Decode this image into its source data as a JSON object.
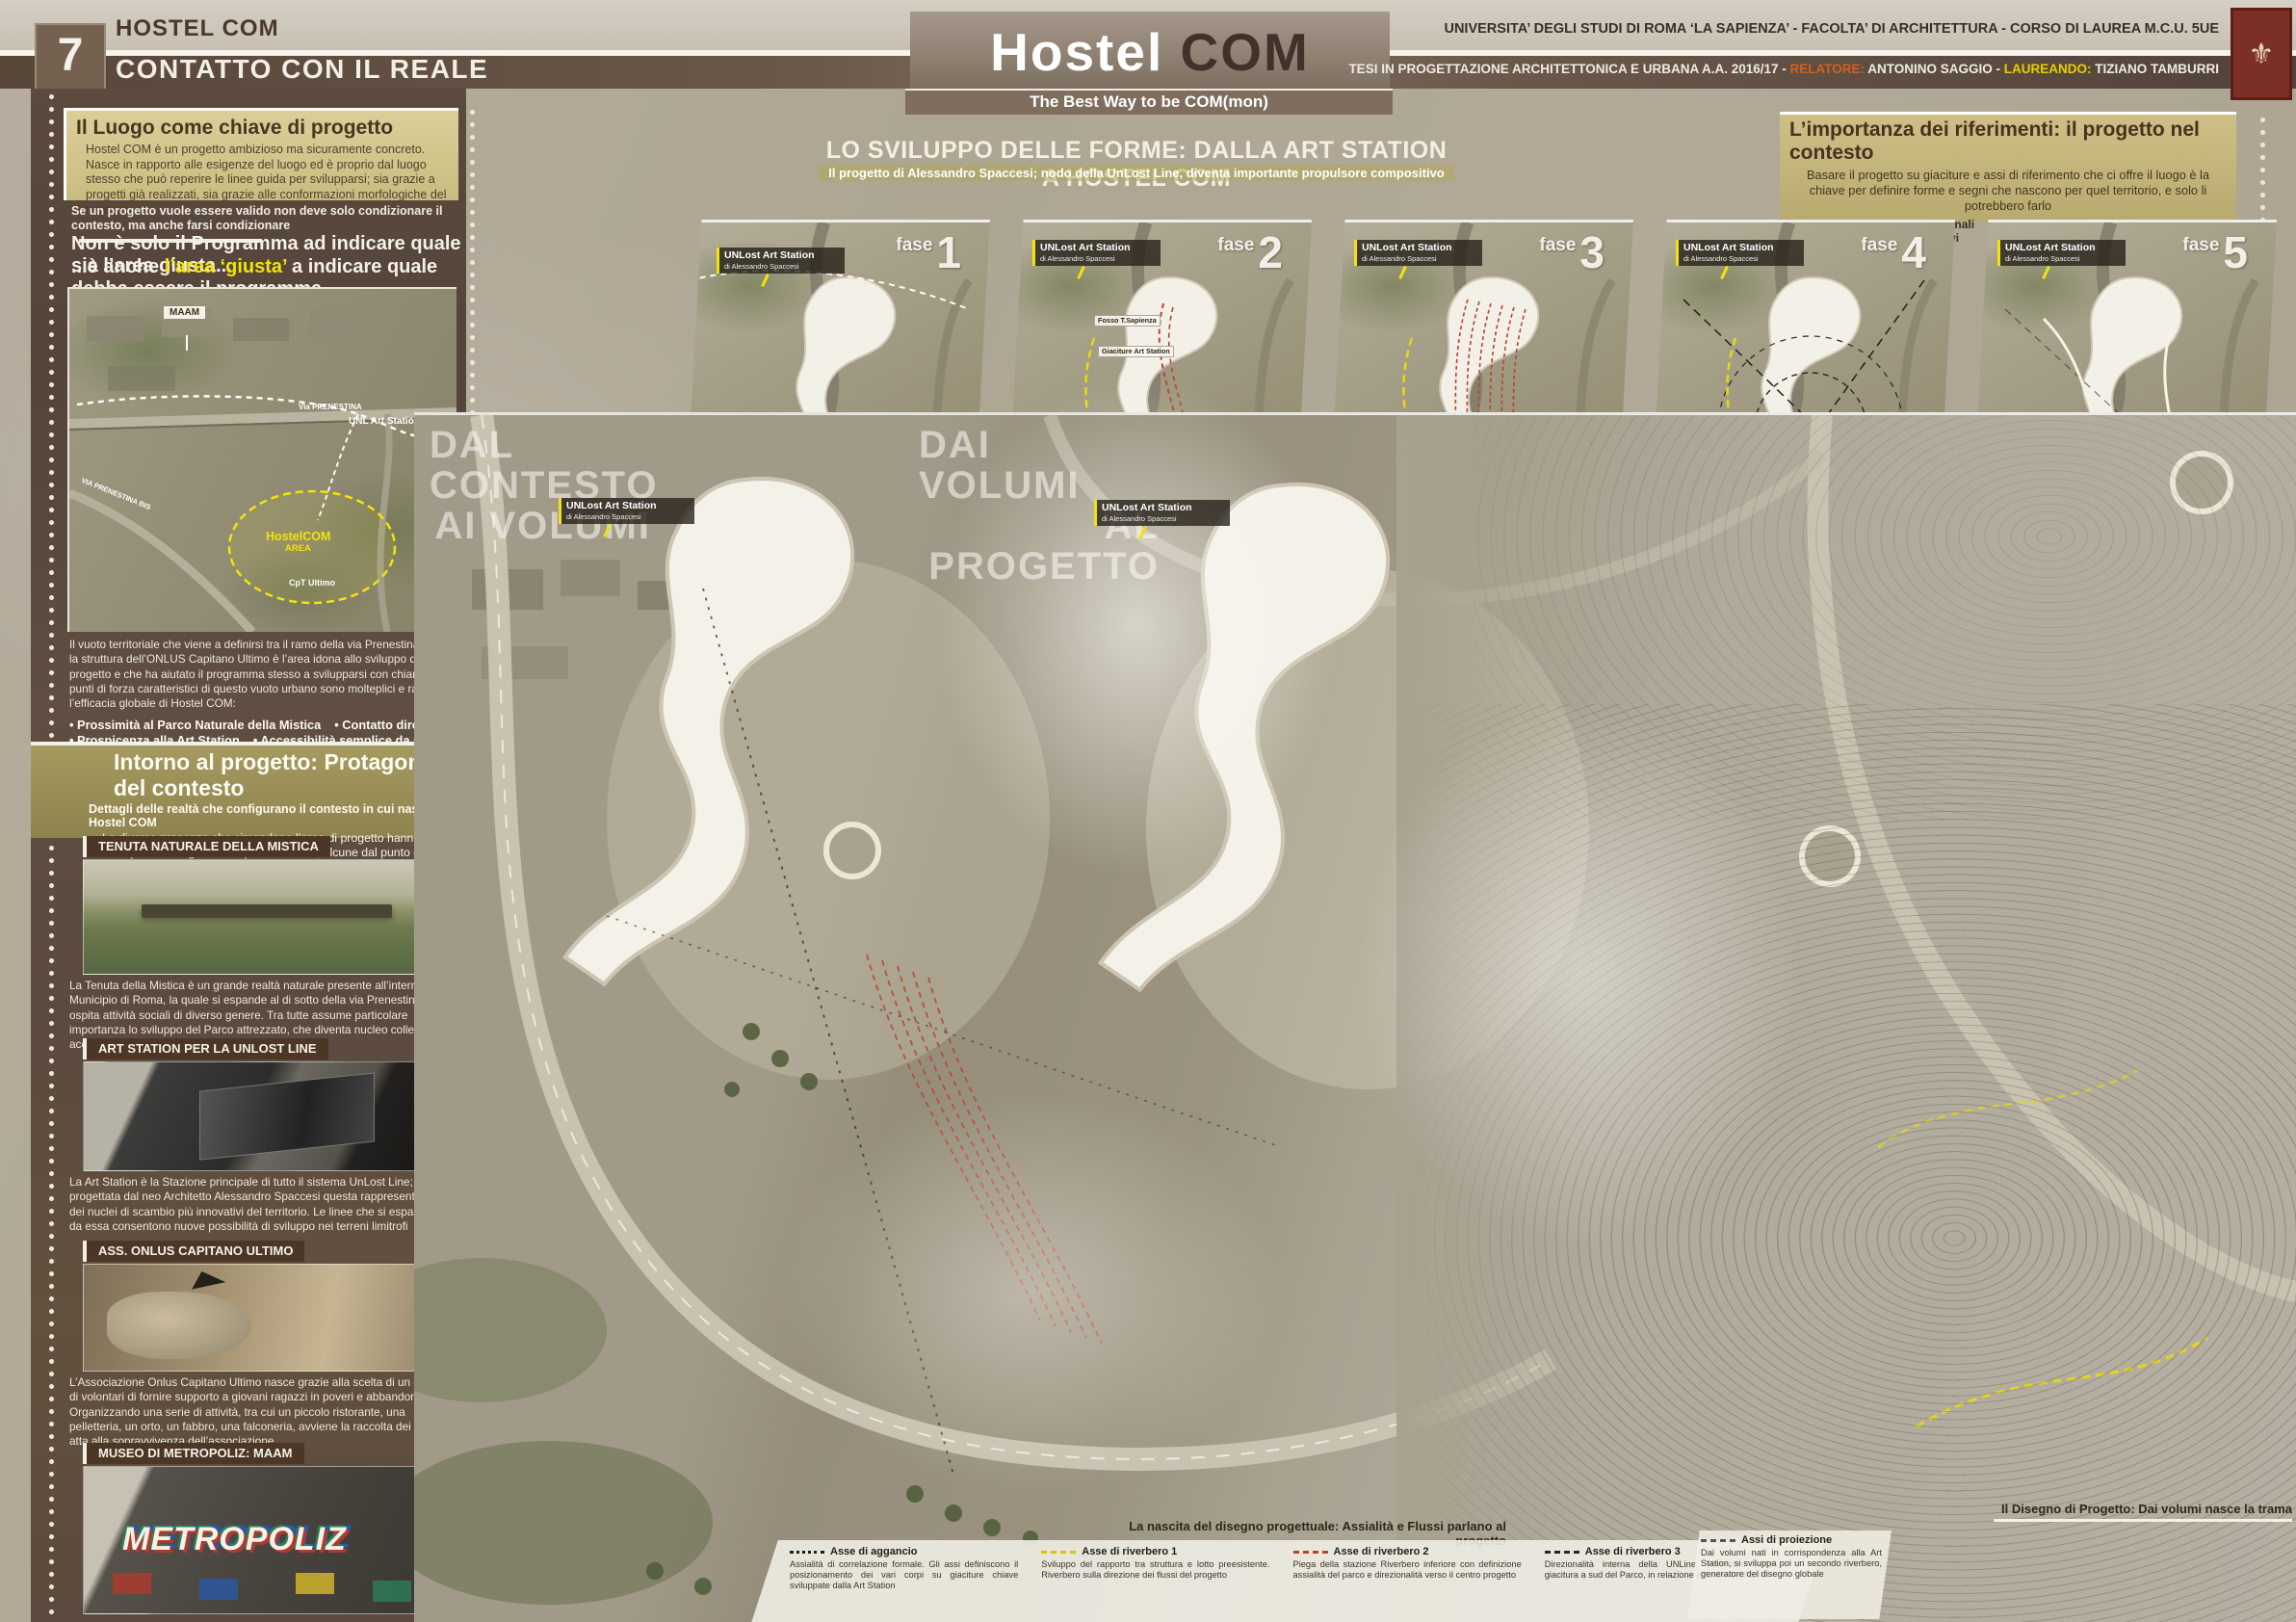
{
  "colors": {
    "accent_yellow": "#f2e30c",
    "axis_red": "#b8432f",
    "relatore_orange": "#d2601e",
    "laureando_yellow": "#e6d000",
    "panel_brown": "#5b4a3d",
    "olive": "#a59a5f"
  },
  "header": {
    "page_number": "7",
    "project": "HOSTEL COM",
    "chapter": "CONTATTO CON IL REALE",
    "title_white": "Hostel",
    "title_brown": "COM",
    "subtitle": "The Best Way to be COM(mon)",
    "university_line": "UNIVERSITA’ DEGLI STUDI DI ROMA ‘LA SAPIENZA’ - FACOLTA’ DI ARCHITETTURA - CORSO DI LAUREA M.C.U. 5UE",
    "thesis_prefix": "TESI IN PROGETTAZIONE ARCHITETTONICA E URBANA A.A. 2016/17 - ",
    "relatore_label": "RELATORE:",
    "relatore_name": " ANTONINO SAGGIO - ",
    "laureando_label": "LAUREANDO:",
    "laureando_name": " TIZIANO TAMBURRI",
    "logo_glyph": "⚜"
  },
  "left": {
    "intro": {
      "heading": "Il Luogo come chiave di progetto",
      "body": "Hostel COM è un progetto ambizioso ma sicuramente concreto. Nasce in rapporto alle esigenze del luogo ed è proprio dal luogo stesso che può reperire le linee guida per svilupparsi; sia grazie a progetti già realizzati, sia grazie alle conformazioni morfologiche del territorio"
    },
    "statement": {
      "small": "Se un progetto vuole essere valido non deve solo condizionare il contesto, ma anche farsi condizionare",
      "line1": "Non è solo il Programma ad indicare quale sia l’area giusta...",
      "line2_pre": "...è anche ",
      "line2_hl": "l’area ‘giusta’",
      "line2_post": " a indicare quale debba essere il programma"
    },
    "map_labels": {
      "maam": "MAAM",
      "via_prenestina": "Via PRENESTINA",
      "via_prenestina_bis": "VIA PRENESTINA BIS",
      "unl_art_station": "UNL Art Station",
      "hostelcom": "HostelCOM",
      "area": "AREA",
      "cpt_ultimo": "CpT Ultimo"
    },
    "vuoto": {
      "body": "Il vuoto territoriale che viene a definirsi tra il ramo della via Prenestina BIS e la struttura dell’ONLUS Capitano Ultimo è l’area idona allo sviluppo di progetto e che ha aiutato il programma stesso a svilupparsi con chiarezza. I punti di forza caratteristici di questo vuoto urbano sono molteplici e rafforzano l’efficacia globale di Hostel COM:",
      "bullets": [
        "Prossimità al Parco Naturale della Mistica",
        "Contatto diretto con l’ONLUS di volontari Capitano Ultimo",
        "Prospicenza alla Art Station",
        "Accessibilità semplice da strada",
        "Vicinanza al Museo di Metropoliz"
      ]
    },
    "intorno": {
      "heading": "Intorno al progetto: Protagonisti del contesto",
      "sub": "Dettagli delle realtà che configurano il contesto in cui nasce Hostel COM",
      "body": "Le diverse presenze che circondano l’area di progetto hanno ognuna un’importanza significativa per il territorio; alcune dal punto di vista ambientale e naturalistico, altre dal punto di vista funzionale o sociale"
    },
    "sections": [
      {
        "header": "TENUTA NATURALE DELLA MISTICA",
        "body": "La Tenuta della Mistica è un grande realtà naturale presente all’interno del IV Municipio di Roma, la quale si espande al di sotto della via Prenestina e ospita attività sociali di diverso genere. Tra tutte assume particolare importanza lo sviluppo del Parco attrezzato, che diventa nucleo collettivo che accoglie ragazzi e famiglie"
      },
      {
        "header": "ART STATION PER LA UNLOST LINE",
        "body": "La Art Station è la Stazione principale di tutto il sistema UnLost Line; progettata dal neo Architetto Alessandro Spaccesi questa rappresenta uno dei nuclei di scambio più innovativi del territorio. Le linee che si espandono da essa consentono nuove possibilità di sviluppo nei terreni limitrofi"
      },
      {
        "header": "ASS. ONLUS CAPITANO ULTIMO",
        "body": "L’Associazione Onlus Capitano Ultimo nasce grazie alla scelta di un gruppo di volontari di fornire supporto a giovani ragazzi in poveri e abbandonati. Organizzando una serie di attività, tra cui un piccolo ristorante, una pelletteria, un orto, un fabbro, una falconeria, avviene la raccolta dei fondi atta alla sopravvivenza dell’associazione"
      },
      {
        "header": "MUSEO DI METROPOLIZ: MAAM",
        "graffiti": "METROPOLIZ"
      }
    ]
  },
  "center": {
    "heading": "LO SVILUPPO DELLE FORME: DALLA ART STATION A HOSTEL COM",
    "sub": "Il progetto di Alessandro Spaccesi; nodo della UnLost Line, diventa importante propulsore compositivo"
  },
  "right_top": {
    "heading": "L’importanza dei riferimenti: il progetto nel contesto",
    "body": "Basare il progetto su giaciture e assi di riferimento che ci offre il luogo è la chiave per definire forme e segni che nascono per quel territorio, e solo li potrebbero farlo",
    "legend_dashed": "Assi direzionali configurativi",
    "legend_arrow": "Flussi principali di giacitura"
  },
  "station_label": {
    "title": "UNLost Art Station",
    "sub": "di Alessandro Spaccesi"
  },
  "phases": [
    {
      "label": "fase",
      "number": "1",
      "caption": "Situazione pre-intervento"
    },
    {
      "label": "fase",
      "number": "2",
      "caption": "Segni significativi del contesto"
    },
    {
      "label": "fase",
      "number": "3",
      "caption": "Riverbero e formazione della griglia"
    },
    {
      "label": "fase",
      "number": "4",
      "caption": "Nucleo e Assialità risultanti"
    },
    {
      "label": "fase",
      "number": "5",
      "caption": "Flussi principali di configurazione"
    }
  ],
  "fase2_annotations": [
    "Fosso T.Sapienza",
    "Giaciture Art Station",
    "Confine Coltivato dalle strade",
    "Depressione morfologica",
    "Piccolo confine Coltivato da l’ONLUS Cpt. Ultimo",
    "Sviluppo della UNLine sull’area"
  ],
  "big_maps": {
    "left_line1": "DAL CONTESTO",
    "left_line2": "AI VOLUMI",
    "right_line1": "DAI VOLUMI",
    "right_line2": "AL PROGETTO",
    "caption_mid": "La nascita del disegno progettuale: Assialità e Flussi parlano al progetto",
    "caption_right": "Il Disegno di Progetto: Dai volumi nasce la trama"
  },
  "bottom_legend": [
    {
      "title": "Asse di aggancio",
      "body": "Assialità di correlazione formale. Gli assi definiscono il posizionamento dei vari corpi su giaciture chiave sviluppate dalla Art Station"
    },
    {
      "title": "Asse di riverbero 1",
      "body": "Sviluppo del rapporto tra struttura e lotto preesistente. Riverbero sulla direzione dei flussi del progetto"
    },
    {
      "title": "Asse di riverbero 2",
      "body": "Piega della stazione Riverbero inferiore con definizione assialità del parco e direzionalità verso il centro progetto"
    },
    {
      "title": "Asse di riverbero 3",
      "body": "Direzionalità interna della UNLine. Riverbero sulla giacitura a sud del Parco, in relazione all’asse del Fosso"
    },
    {
      "title": "Assi di proiezione",
      "body": "Dai volumi nati in corrispondenza alla Art Station, si sviluppa poi un secondo riverbero, generatore del disegno globale"
    }
  ]
}
